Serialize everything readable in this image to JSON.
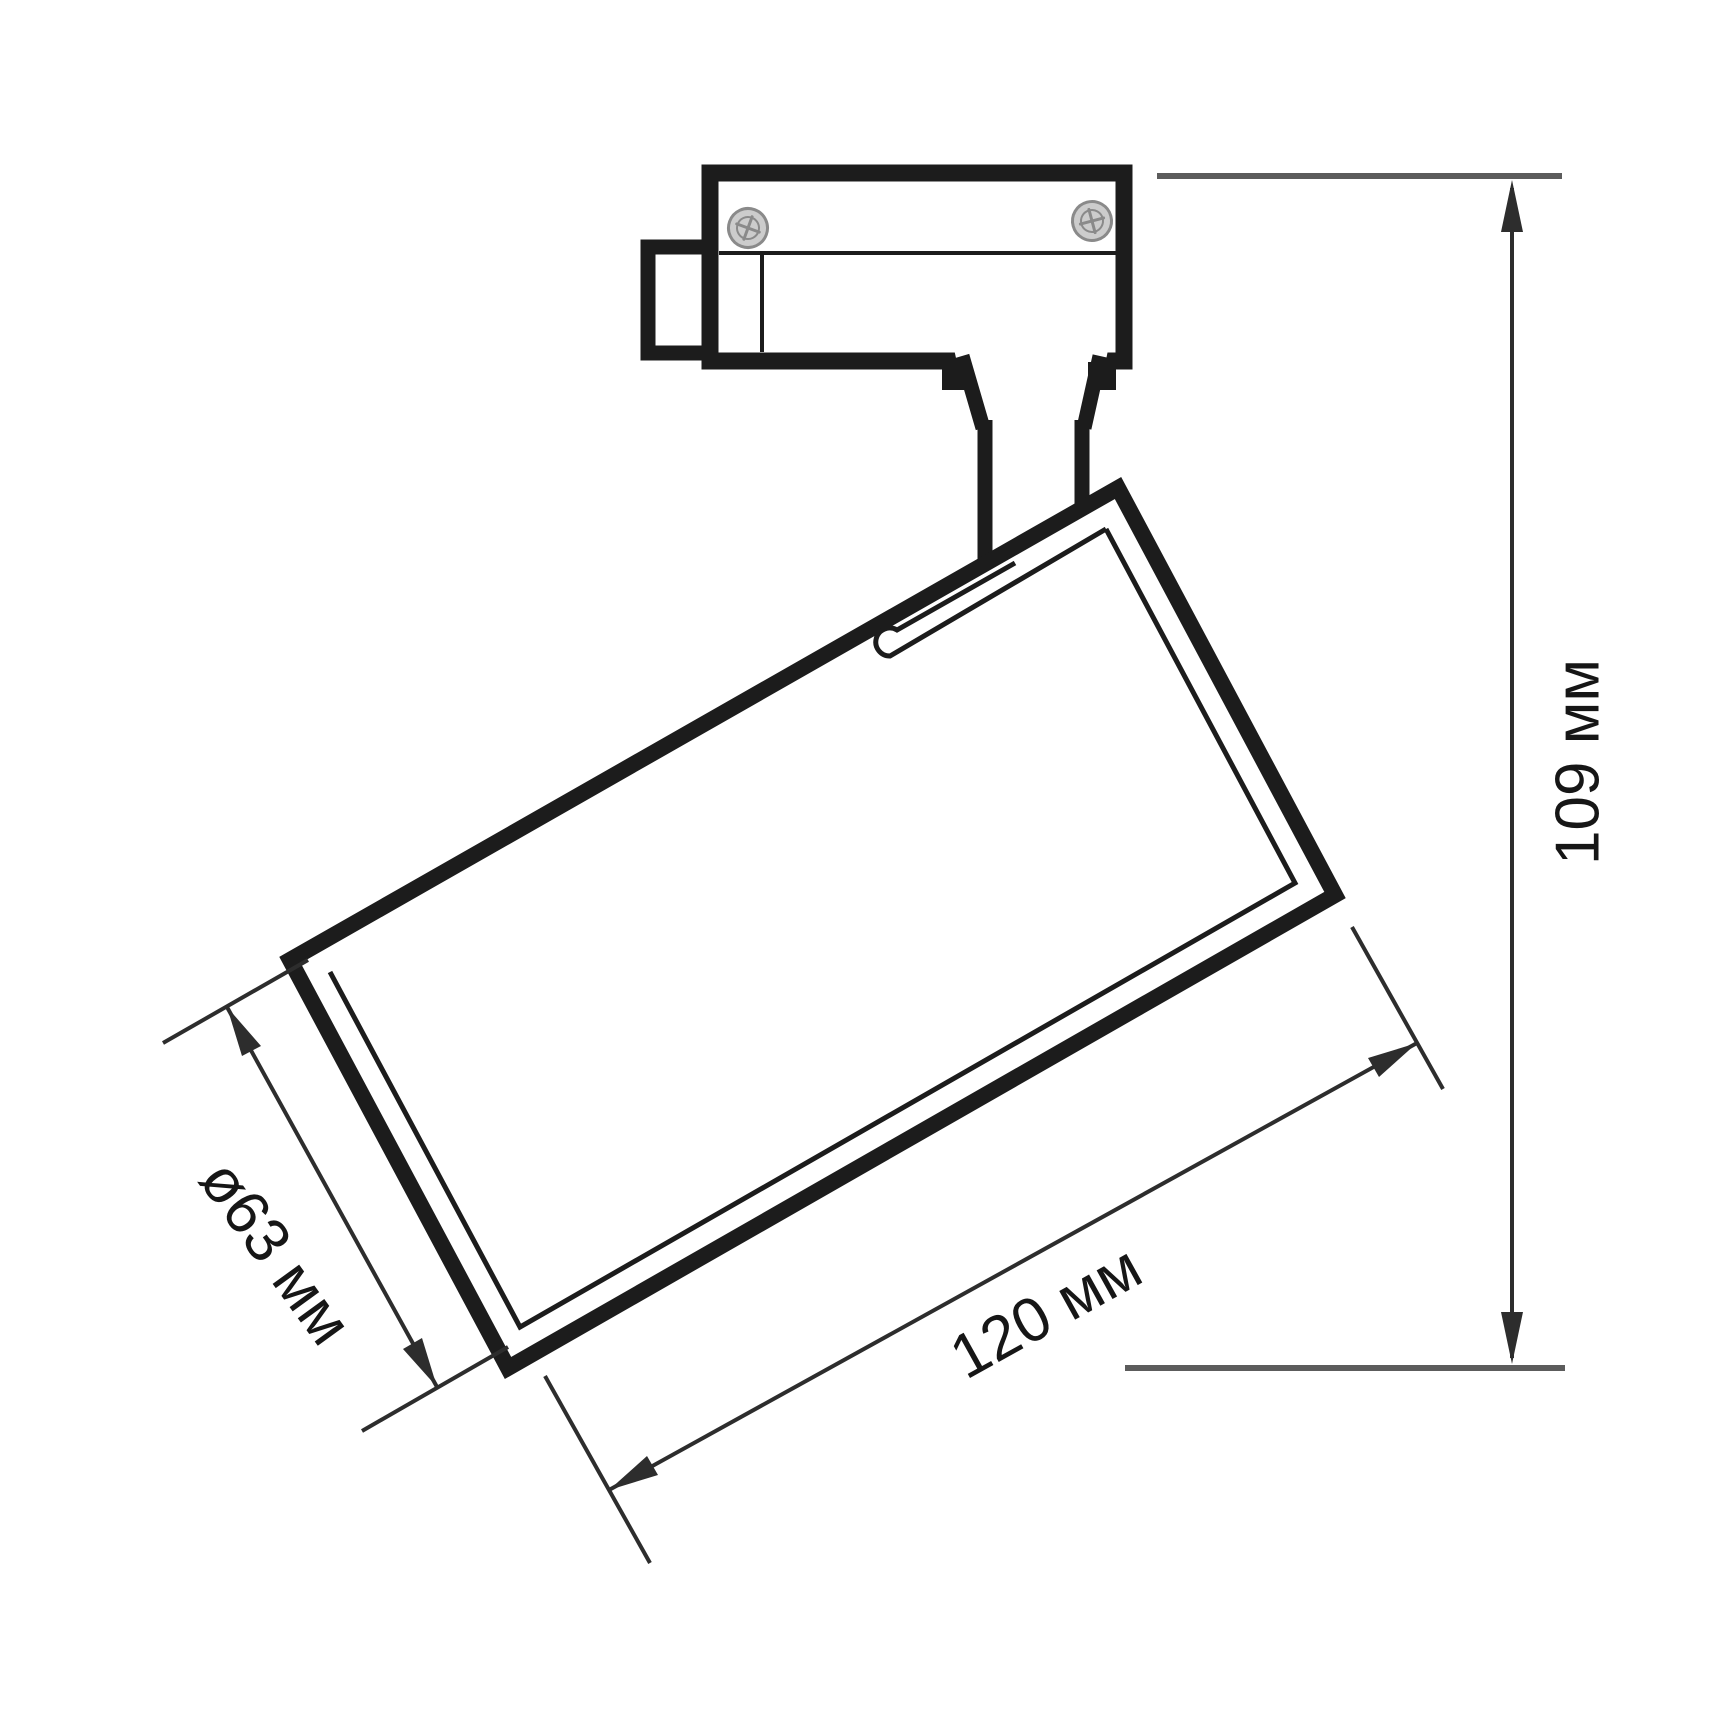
{
  "page": {
    "background": "#ffffff"
  },
  "colors": {
    "line": "#1c1c1c",
    "dim": "#2d2d2d",
    "ref": "#5c5c5c",
    "text": "#161616",
    "screw-fill": "#cccccc",
    "screw-stroke": "#8a8a8a"
  },
  "drawing": {
    "subject": "track-mounted LED spotlight dimensional drawing",
    "labels": {
      "height": "109 мм",
      "length": "120 мм",
      "diameter": "ø63 мм"
    }
  }
}
